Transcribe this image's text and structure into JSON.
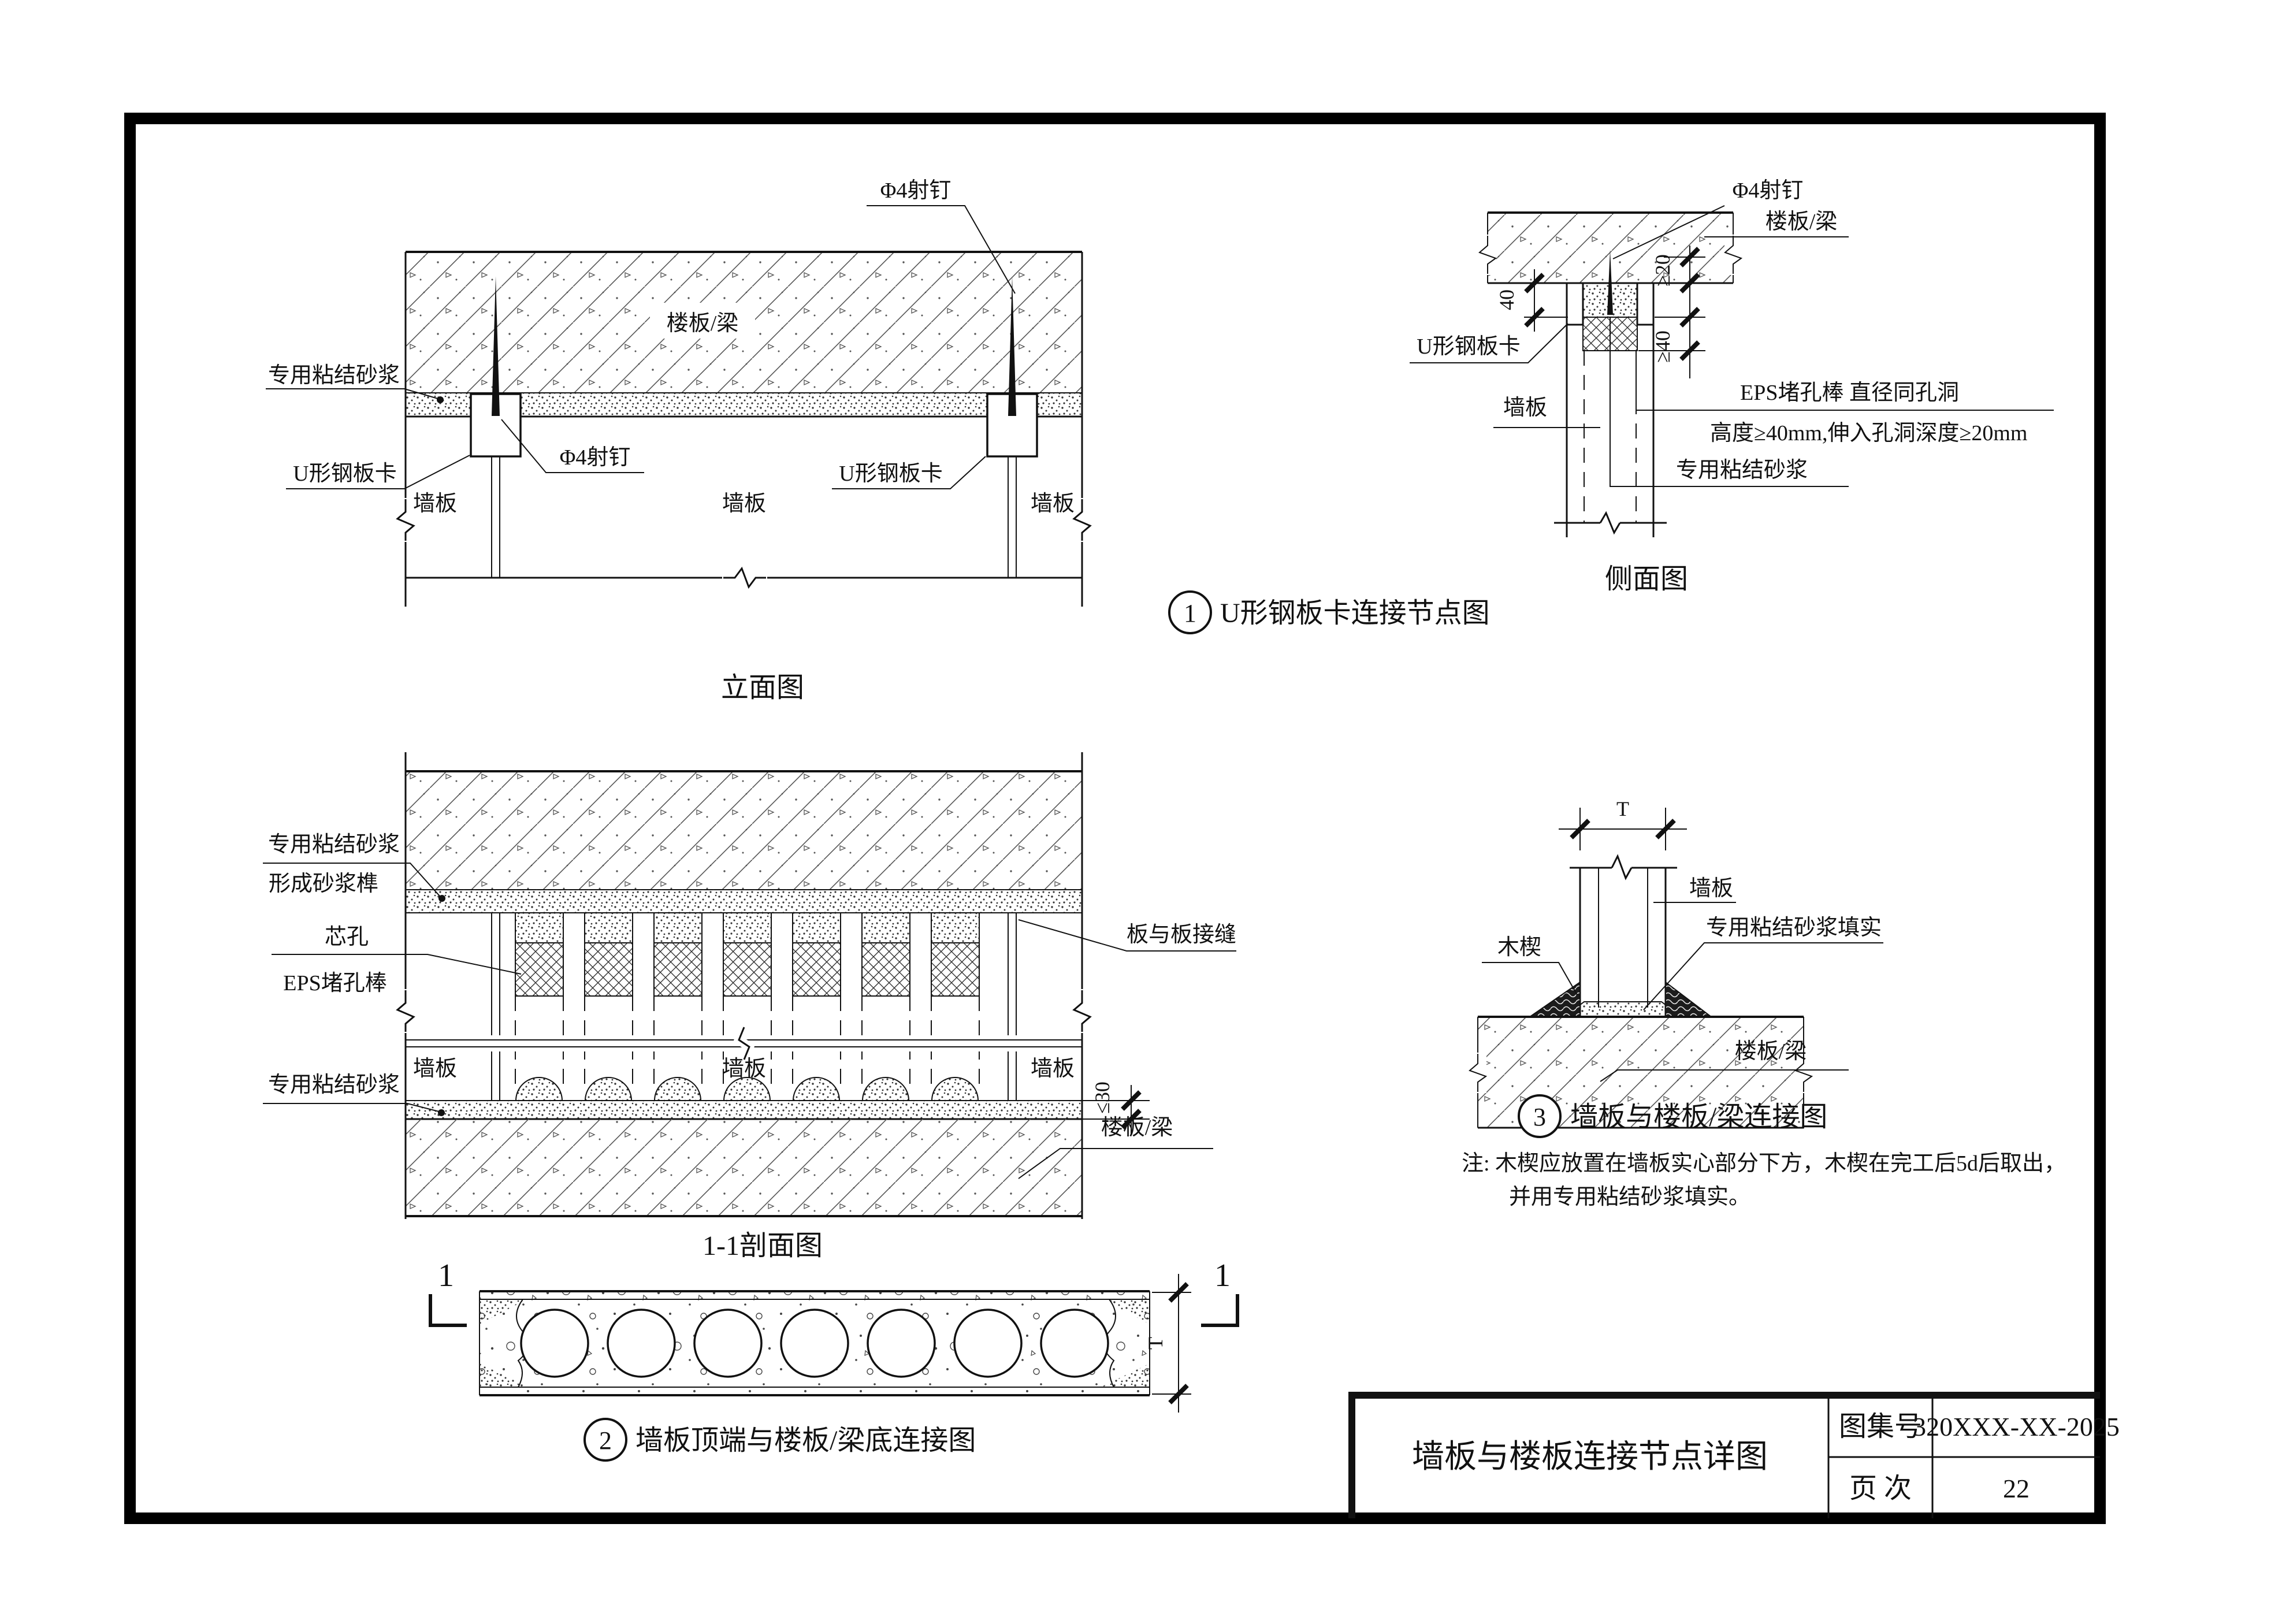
{
  "title_block": {
    "title": "墙板与楼板连接节点详图",
    "atlas_label": "图集号",
    "atlas_value": "320XXX-XX-2025",
    "page_label": "页  次",
    "page_value": "22"
  },
  "elevation": {
    "caption": "立面图",
    "slab_label": "楼板/梁",
    "mortar_label": "专用粘结砂浆",
    "u_clip_left": "U形钢板卡",
    "u_clip_right": "U形钢板卡",
    "nail_top": "Φ4射钉",
    "nail_mid": "Φ4射钉",
    "wall_left": "墙板",
    "wall_center": "墙板",
    "wall_right": "墙板"
  },
  "side_view": {
    "caption": "侧面图",
    "nail": "Φ4射钉",
    "slab_label": "楼板/梁",
    "u_clip": "U形钢板卡",
    "wall": "墙板",
    "eps_line1": "EPS堵孔棒 直径同孔洞",
    "eps_line2": "高度≥40mm,伸入孔洞深度≥20mm",
    "mortar_label": "专用粘结砂浆",
    "dim_40": "40",
    "dim_ge20": "≥20",
    "dim_ge40": "≥40"
  },
  "detail1": {
    "number": "1",
    "caption": "U形钢板卡连接节点图"
  },
  "section": {
    "caption": "1-1剖面图",
    "slab_top": "楼板/梁",
    "mortar_line1": "专用粘结砂浆",
    "mortar_line2": "形成砂浆榫",
    "core_line1": "芯孔",
    "core_line2": "EPS堵孔棒",
    "joint_label": "板与板接缝",
    "wall_left": "墙板",
    "wall_center": "墙板",
    "wall_right": "墙板",
    "mortar_bottom": "专用粘结砂浆",
    "slab_bottom": "楼板/梁",
    "dim_le30": "≤30"
  },
  "plan": {
    "number": "2",
    "caption": "墙板顶端与楼板/梁底连接图",
    "marker_left": "1",
    "marker_right": "1",
    "dim_t": "T"
  },
  "detail3": {
    "number": "3",
    "caption": "墙板与楼板/梁连接图",
    "dim_t": "T",
    "wall": "墙板",
    "mortar_fill": "专用粘结砂浆填实",
    "wedge": "木楔",
    "slab_label": "楼板/梁",
    "note_line1": "注: 木楔应放置在墙板实心部分下方，木楔在完工后5d后取出，",
    "note_line2": "并用专用粘结砂浆填实。"
  }
}
